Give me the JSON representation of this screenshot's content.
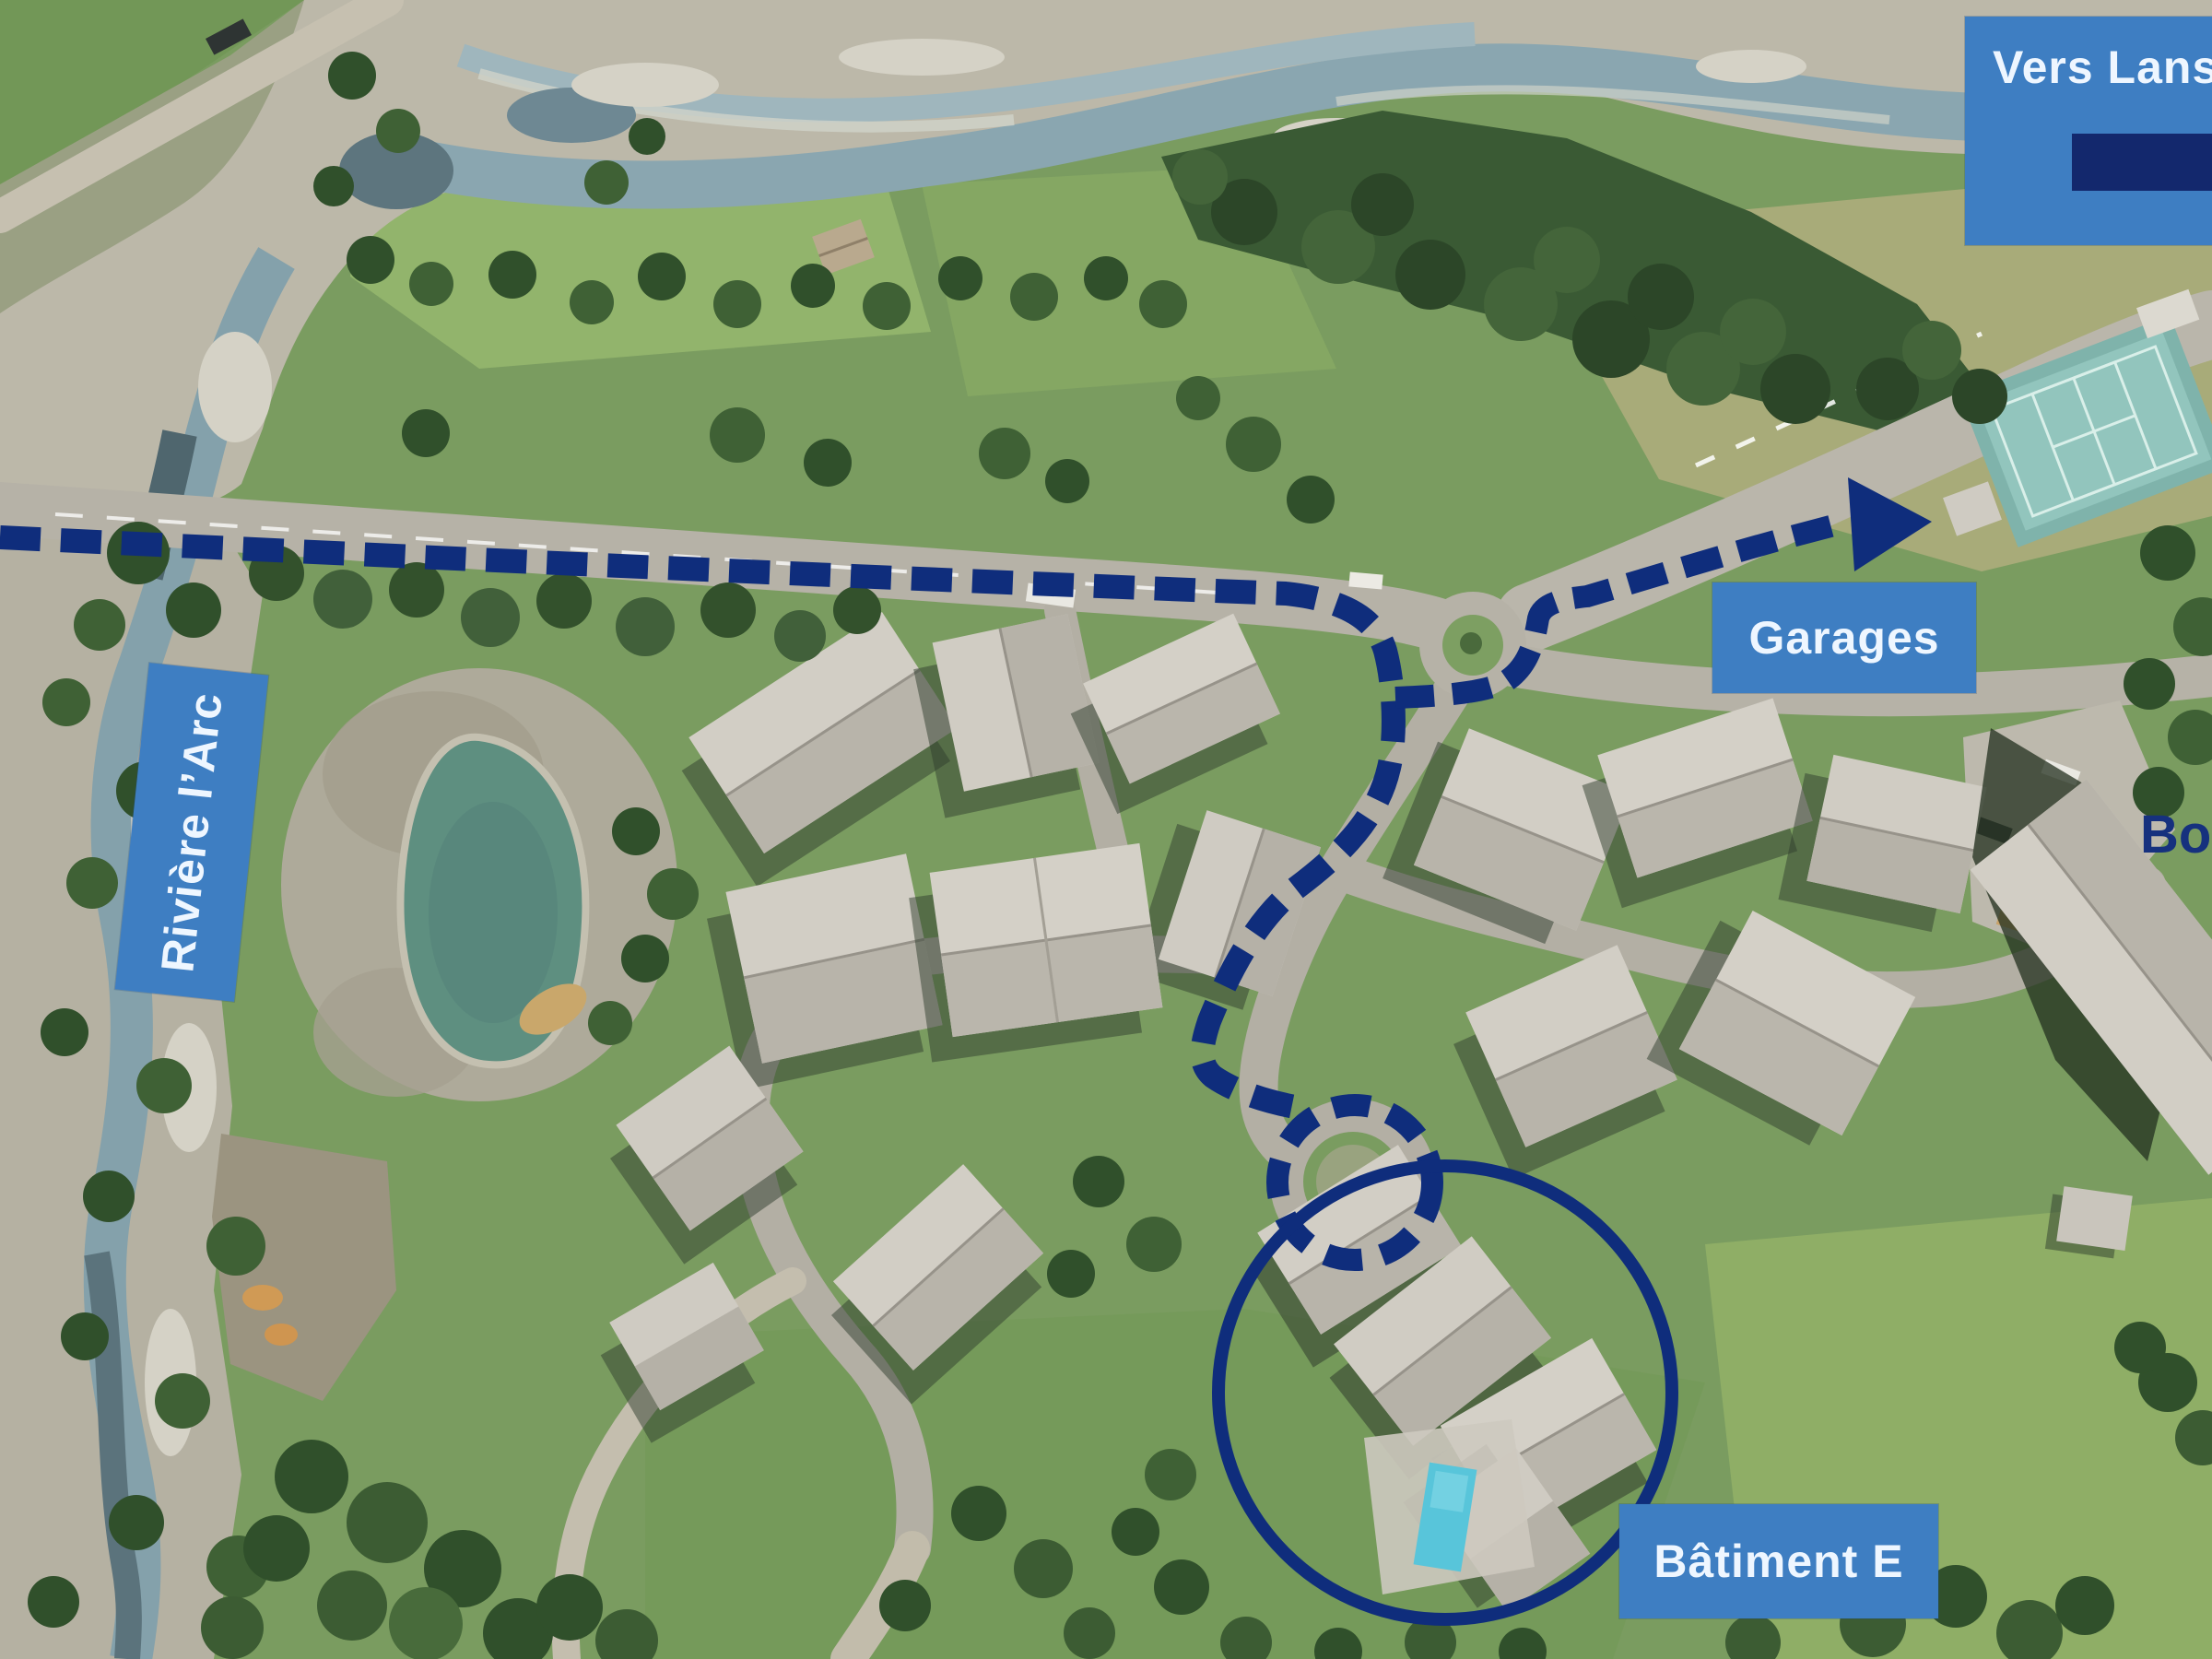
{
  "annotations": {
    "labels": {
      "destination": "Vers Lansl",
      "garages": "Garages",
      "river": "Rivière l’Arc",
      "building_e": "Bâtiment E",
      "partial_right": "Bou"
    },
    "colors": {
      "label_bg": "#3e7ec2",
      "label_text": "#eef6ff",
      "route": "#0f2d7c",
      "legend_bar": "#13286d",
      "partial_text": "#16317e"
    },
    "route_style": "dashed",
    "arrow_icon": "right-arrowhead",
    "highlight_shape": "circle"
  }
}
